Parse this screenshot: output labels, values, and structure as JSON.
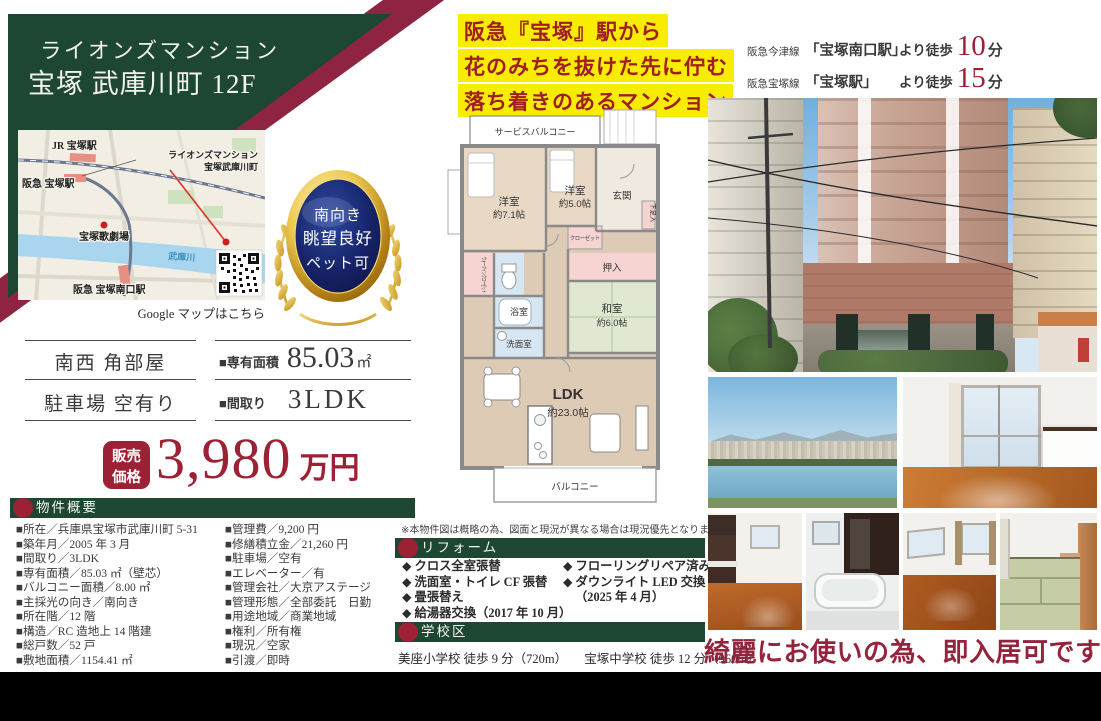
{
  "header": {
    "line1": "ライオンズマンション",
    "line2": "宝塚 武庫川町 12F"
  },
  "catch": {
    "line1": "阪急『宝塚』駅から",
    "line2": "花のみちを抜けた先に佇む",
    "line3": "落ち着きのあるマンション"
  },
  "access": {
    "row1": {
      "line": "阪急今津線",
      "station": "「宝塚南口駅」",
      "walk": "より徒歩",
      "min": "10",
      "unit": "分"
    },
    "row2": {
      "line": "阪急宝塚線",
      "station": "「宝塚駅」",
      "walk": "より徒歩",
      "min": "15",
      "unit": "分"
    }
  },
  "map": {
    "jr_station": "JR 宝塚駅",
    "hankyu_station": "阪急 宝塚駅",
    "property_line1": "ライオンズマンション",
    "property_line2": "宝塚武庫川町",
    "theater": "宝塚歌劇場",
    "river": "武庫川",
    "minamiguchi_station": "阪急 宝塚南口駅",
    "caption": "Google マップはこちら"
  },
  "badge": {
    "line1": "南向き",
    "line2": "眺望良好",
    "line3": "ペット可"
  },
  "specs": {
    "position": "南西 角部屋",
    "parking": "駐車場 空有り",
    "area_label": "■専有面積",
    "area_value": "85.03",
    "area_unit": "㎡",
    "layout_label": "■間取り",
    "layout_value": "3LDK"
  },
  "price": {
    "badge1": "販売",
    "badge2": "価格",
    "value": "3,980",
    "unit": "万円"
  },
  "overview": {
    "title": "物件概要",
    "left": [
      "■所在／兵庫県宝塚市武庫川町 5-31",
      "■築年月／2005 年 3 月",
      "■間取り／3LDK",
      "■専有面積／85.03 ㎡（壁芯）",
      "■バルコニー面積／8.00 ㎡",
      "■主採光の向き／南向き",
      "■所在階／12 階",
      "■構造／RC 造地上 14 階建",
      "■総戸数／52 戸",
      "■敷地面積／1154.41 ㎡"
    ],
    "right": [
      "■管理費／9,200 円",
      "■修繕積立金／21,260 円",
      "■駐車場／空有",
      "■エレベーター／有",
      "■管理会社／大京アステージ",
      "■管理形態／全部委託　日勤",
      "■用途地域／商業地域",
      "■権利／所有権",
      "■現況／空家",
      "■引渡／即時"
    ]
  },
  "floorplan": {
    "service_balcony": "サービスバルコニー",
    "bedroom1": "洋室",
    "bedroom1_size": "約7.1帖",
    "bedroom2": "洋室",
    "bedroom2_size": "約5.0帖",
    "genkan": "玄関",
    "shoe_box": "下足入",
    "closet": "クローゼット",
    "wic": "ウォークインクローゼット",
    "bath": "浴室",
    "washroom": "洗面室",
    "oshiire": "押入",
    "washitsu": "和室",
    "washitsu_size": "約6.0帖",
    "ldk": "LDK",
    "ldk_size": "約23.0帖",
    "balcony": "バルコニー",
    "note": "※本物件図は概略の為、図面と現況が異なる場合は現況優先となります。"
  },
  "reform": {
    "title": "リフォーム",
    "col1": [
      "◆ クロス全室張替",
      "◆ 洗面室・トイレ CF 張替",
      "◆ 畳張替え",
      "◆ 給湯器交換（2017 年 10 月）"
    ],
    "col2": [
      "◆ フローリングリペア済み",
      "◆ ダウンライト LED 交換",
      "（2025 年 4 月）"
    ]
  },
  "school": {
    "title": "学校区",
    "elementary": "美座小学校 徒歩 9 分（720m）",
    "junior": "宝塚中学校 徒歩 12 分（960m）"
  },
  "bottom_note": "綺麗にお使いの為、即入居可です",
  "colors": {
    "green": "#1e4733",
    "crimson": "#8e2342",
    "price_red": "#9c2134",
    "highlight_yellow": "#f8ec00",
    "badge_navy": "#17246b",
    "badge_gold": "#c9951d"
  }
}
